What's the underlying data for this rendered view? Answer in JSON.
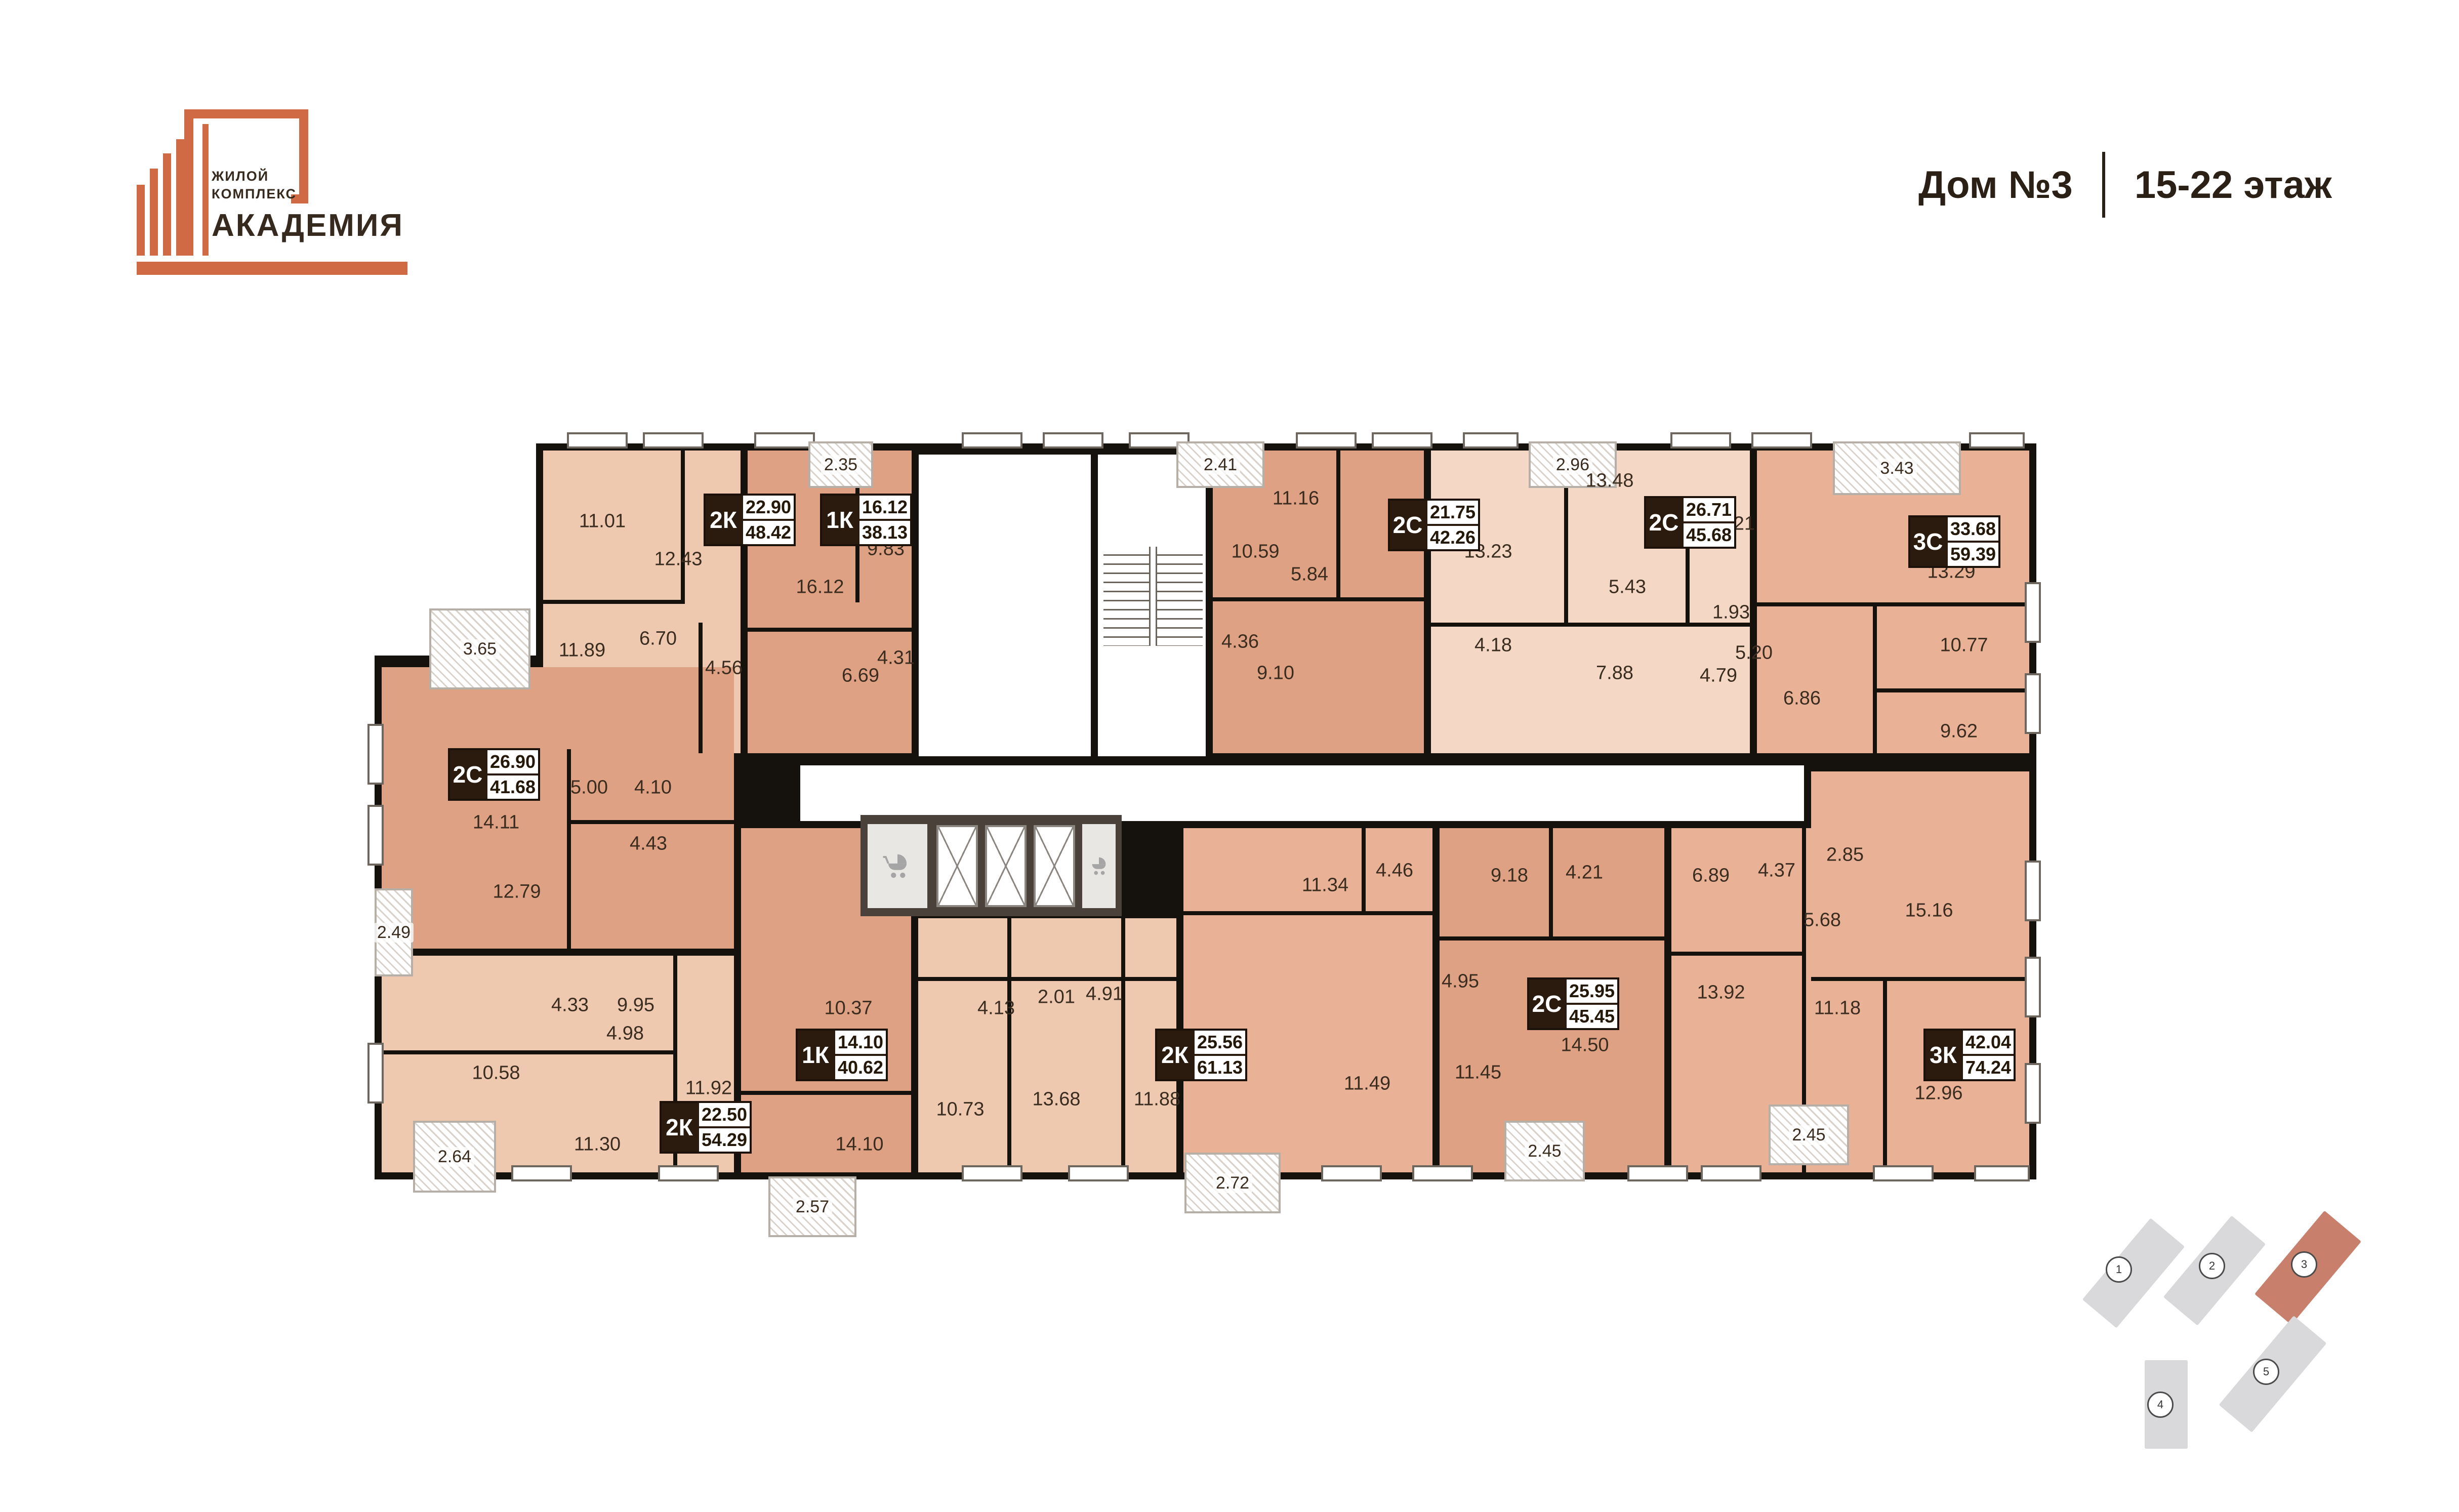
{
  "logo": {
    "line1": "ЖИЛОЙ",
    "line2": "КОМПЛЕКС",
    "name": "АКАДЕМИЯ",
    "accent_color": "#cf6a45",
    "text_color": "#362a1e"
  },
  "header": {
    "house": "Дом №3",
    "floors": "15-22 этаж"
  },
  "floorplan": {
    "wall_color": "#15110c",
    "apartments": [
      {
        "type": "2К",
        "living": "22.90",
        "total": "48.42"
      },
      {
        "type": "1К",
        "living": "16.12",
        "total": "38.13"
      },
      {
        "type": "2С",
        "living": "21.75",
        "total": "42.26"
      },
      {
        "type": "2С",
        "living": "26.71",
        "total": "45.68"
      },
      {
        "type": "3С",
        "living": "33.68",
        "total": "59.39"
      },
      {
        "type": "2С",
        "living": "26.90",
        "total": "41.68"
      },
      {
        "type": "2К",
        "living": "22.50",
        "total": "54.29"
      },
      {
        "type": "1К",
        "living": "14.10",
        "total": "40.62"
      },
      {
        "type": "2К",
        "living": "25.56",
        "total": "61.13"
      },
      {
        "type": "2С",
        "living": "25.95",
        "total": "45.45"
      },
      {
        "type": "3К",
        "living": "42.04",
        "total": "74.24"
      }
    ],
    "rooms": [
      "11.01",
      "12.43",
      "11.89",
      "6.70",
      "4.56",
      "16.12",
      "9.83",
      "6.69",
      "4.31",
      "10.59",
      "11.16",
      "5.84",
      "4.36",
      "9.10",
      "13.23",
      "13.48",
      "5.43",
      "5.21",
      "1.93",
      "4.18",
      "7.88",
      "4.79",
      "5.20",
      "13.29",
      "10.77",
      "9.62",
      "6.86",
      "14.11",
      "5.00",
      "4.10",
      "4.43",
      "12.79",
      "4.33",
      "9.95",
      "4.98",
      "10.58",
      "11.92",
      "11.30",
      "10.37",
      "14.10",
      "10.73",
      "13.68",
      "11.88",
      "4.91",
      "2.01",
      "4.13",
      "11.34",
      "4.46",
      "11.49",
      "4.95",
      "11.45",
      "9.18",
      "4.21",
      "14.50",
      "6.89",
      "4.37",
      "2.85",
      "5.68",
      "15.16",
      "13.92",
      "11.18",
      "12.96"
    ],
    "balconies": [
      "3.65",
      "2.35",
      "2.41",
      "2.96",
      "3.43",
      "2.49",
      "2.64",
      "2.57",
      "2.72",
      "2.45",
      "2.45"
    ]
  },
  "minimap": {
    "buildings": [
      "1",
      "2",
      "3",
      "4",
      "5"
    ],
    "active": "3",
    "active_color": "#c8806d",
    "inactive_color": "#d9d9db"
  }
}
